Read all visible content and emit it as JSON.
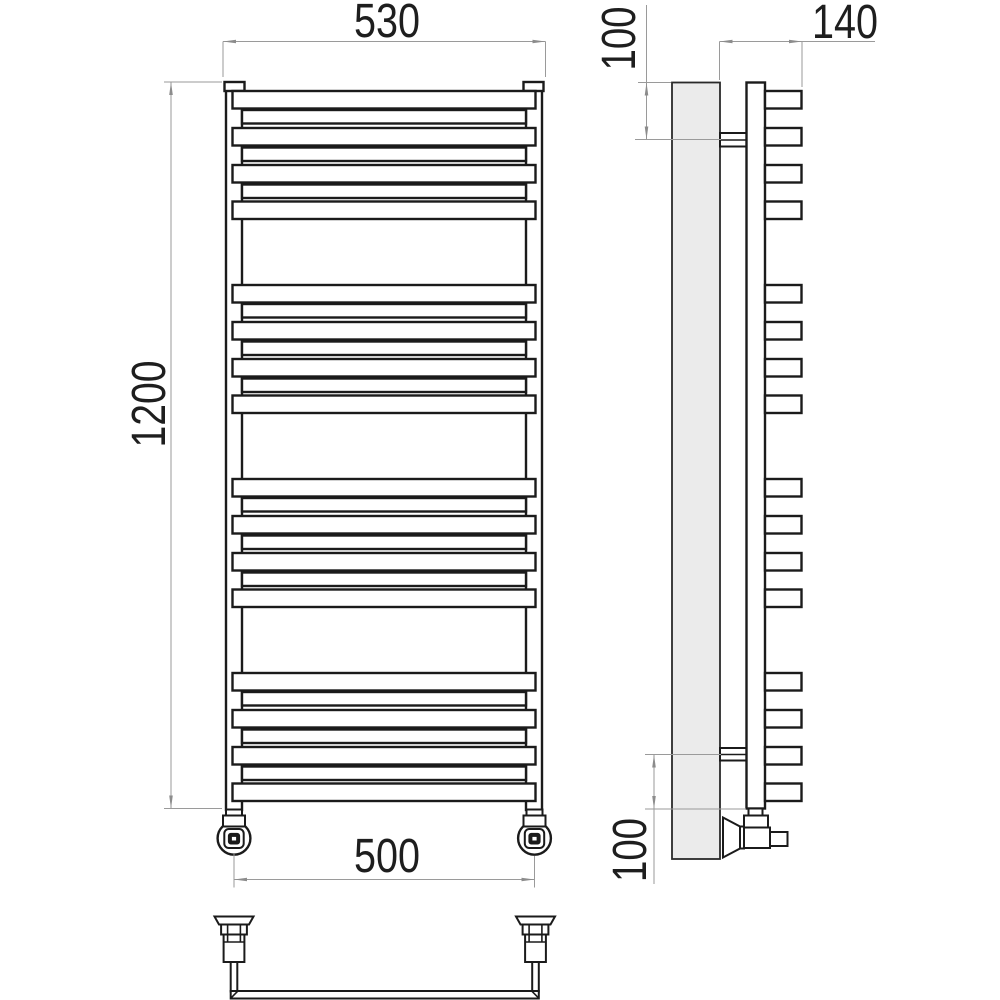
{
  "drawing": {
    "dimensions": {
      "overall_width": "530",
      "overall_height": "1200",
      "connection_spacing": "500",
      "overall_depth": "140",
      "top_bracket_offset": "100",
      "bottom_bracket_offset": "100"
    }
  }
}
